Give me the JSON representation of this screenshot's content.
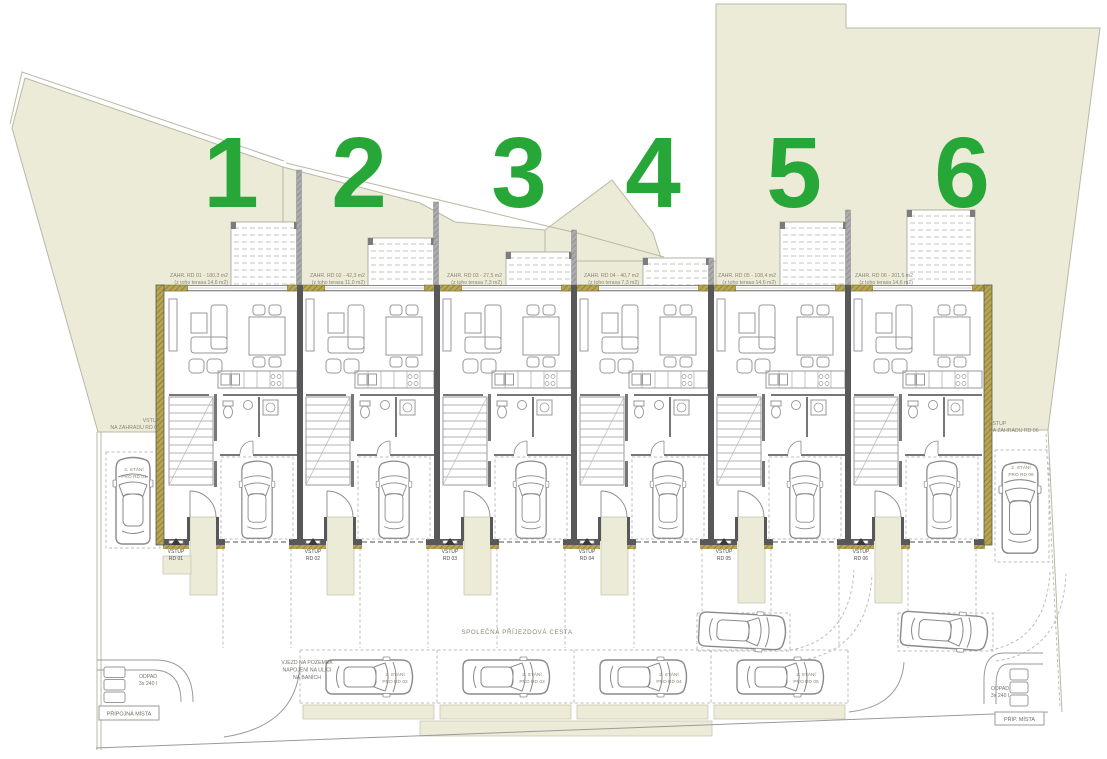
{
  "colors": {
    "accent_green": "#27a737",
    "parcel": "#ecebd8",
    "parcel_line": "#b9b8a6",
    "wall": "#58585a",
    "insulation": "#b7a54f",
    "line_gray": "#9a9a9c",
    "dash_gray": "#bcbcbe",
    "text_gray": "#8b8578",
    "text_dark": "#4a4a4c"
  },
  "plot_numbers": [
    "1",
    "2",
    "3",
    "4",
    "5",
    "6"
  ],
  "garden_labels": [
    {
      "area": "ZAHR. RD 01 - 180,3 m2",
      "terrace": "(z toho terasa 14,6 m2)"
    },
    {
      "area": "ZAHR. RD 02 - 42,3 m2",
      "terrace": "(z toho terasa 11,0 m2)"
    },
    {
      "area": "ZAHR. RD 03 - 27,5 m2",
      "terrace": "(z toho terasa 7,3 m2)"
    },
    {
      "area": "ZAHR. RD 04 - 40,7 m2",
      "terrace": "(z toho terasa 7,3 m2)"
    },
    {
      "area": "ZAHR. RD 05 - 108,4 m2",
      "terrace": "(z toho terasa 14,6 m2)"
    },
    {
      "area": "ZAHR. RD 06 - 201,5 m2",
      "terrace": "(z toho terasa 14,6 m2)"
    }
  ],
  "unit_entrances": [
    [
      "VSTUP",
      "RD 01"
    ],
    [
      "VSTUP",
      "RD 02"
    ],
    [
      "VSTUP",
      "RD 03"
    ],
    [
      "VSTUP",
      "RD 04"
    ],
    [
      "VSTUP",
      "RD 05"
    ],
    [
      "VSTUP",
      "RD 06"
    ]
  ],
  "garden_entrances": {
    "left": [
      "VSTUP",
      "NA ZAHRADU RD 01"
    ],
    "right": [
      "VSTUP",
      "NA ZAHRADU RD 06"
    ]
  },
  "parking": {
    "left": [
      "2. STÁNÍ",
      "PRO RD 01"
    ],
    "right": [
      "2. STÁNÍ",
      "PRO RD 06"
    ],
    "row": [
      [
        "2. STÁNÍ",
        "PRO RD 02"
      ],
      [
        "2. STÁNÍ",
        "PRO RD 03"
      ],
      [
        "2. STÁNÍ",
        "PRO RD 04"
      ],
      [
        "2. STÁNÍ",
        "PRO RD 05"
      ]
    ]
  },
  "road_label": "SPOLEČNÁ PŘÍJEZDOVÁ CESTA",
  "entry_note": [
    "VJEZD NA POZEMEK",
    "NAPOJENÍ NA ULICI",
    "NA BANÍCH"
  ],
  "waste": {
    "left": [
      "ODPAD",
      "3x 240 l"
    ],
    "right": [
      "ODPAD",
      "3x 240 l"
    ]
  },
  "connection_points": {
    "left": "PŘÍPOJNÁ MÍSTA",
    "right": "PŘÍP. MÍSTA"
  }
}
